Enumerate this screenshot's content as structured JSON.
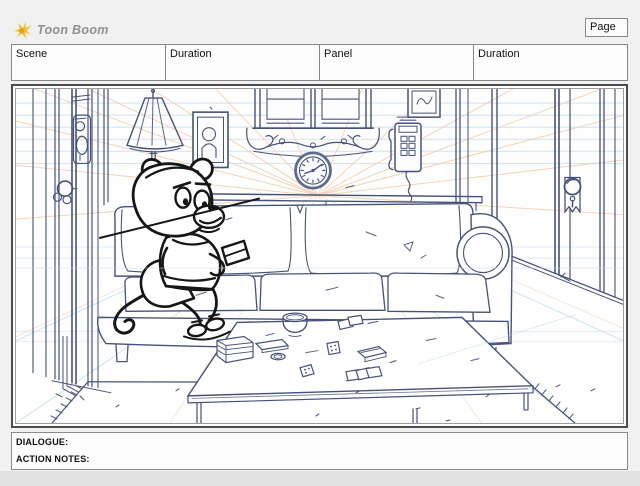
{
  "header": {
    "logo_text": "Toon Boom",
    "page_label": "Page"
  },
  "fields_row": {
    "columns": [
      {
        "label": "Scene"
      },
      {
        "label": "Duration"
      },
      {
        "label": "Panel"
      },
      {
        "label": "Duration"
      }
    ]
  },
  "notes": {
    "dialogue_label": "DIALOGUE:",
    "action_notes_label": "ACTION NOTES:"
  },
  "panel": {
    "drawing_elements": [
      "perspective-guides",
      "left-door",
      "floor-lamp",
      "picture-frame",
      "center-window-with-valance",
      "wall-clock",
      "small-picture-frame",
      "wall-phone",
      "right-wall-door",
      "sofa-shelf",
      "sofa",
      "rug",
      "coffee-table",
      "table-items",
      "cat-character-sketch"
    ]
  },
  "colors": {
    "page_background": "#f1f1f1",
    "footer_background": "#e1e1e1",
    "box_border": "#8a8a8a",
    "panel_border": "#4c4c4c",
    "line_art": "#46527a",
    "character_ink": "#161616",
    "guide_orange": "#f2cda9",
    "guide_blue": "#c6daec",
    "guide_cyan": "#b8d8e4",
    "logo_yellow": "#f0c12e",
    "logo_text_gray": "#8f8f8f"
  }
}
